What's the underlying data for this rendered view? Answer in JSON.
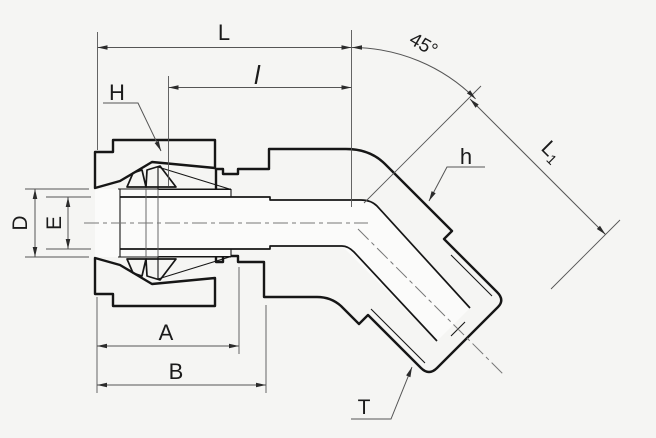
{
  "drawing_labels": {
    "overall_length": "L",
    "insert_length": "l",
    "angle": "45°",
    "nut_hex": "H",
    "body_hex": "h",
    "l1_base": "L",
    "l1_sub": "1",
    "tube_od": "D",
    "bore": "E",
    "length_a": "A",
    "length_b": "B",
    "thread": "T"
  },
  "colors": {
    "background": "#f5f5f3",
    "body_fill": "#d8d8d5",
    "nut_fill": "#d0d0cd",
    "bore_fill": "#fbfbfa",
    "outline": "#161616",
    "dim_color": "#555555",
    "arrow": "#2b2b2b",
    "text": "#1b1b1b",
    "hatch": "#8f8f8f"
  }
}
